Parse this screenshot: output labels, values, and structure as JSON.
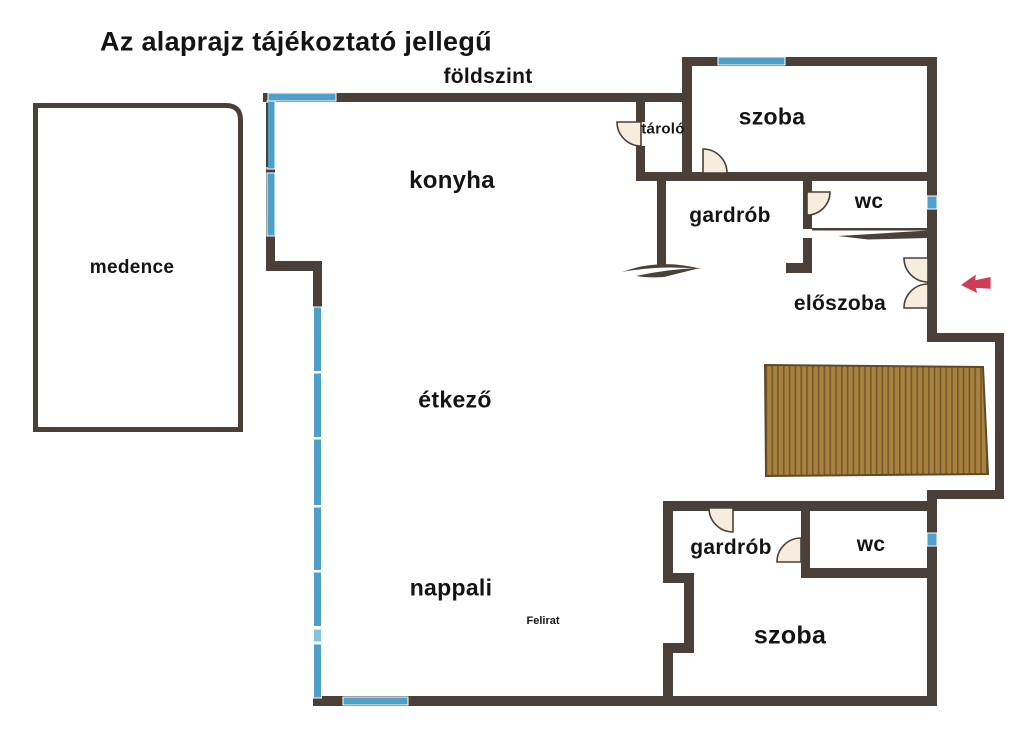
{
  "title": "Az alaprajz tájékoztató jellegű",
  "floor_label": "földszint",
  "note_label": "Felirat",
  "rooms": [
    {
      "id": "medence",
      "label": "medence"
    },
    {
      "id": "konyha",
      "label": "konyha"
    },
    {
      "id": "tarolo",
      "label": "tároló"
    },
    {
      "id": "szoba-felso",
      "label": "szoba"
    },
    {
      "id": "gardrob-felso",
      "label": "gardrób"
    },
    {
      "id": "wc-felso",
      "label": "wc"
    },
    {
      "id": "eloszoba",
      "label": "előszoba"
    },
    {
      "id": "etkezo",
      "label": "étkező"
    },
    {
      "id": "nappali",
      "label": "nappali"
    },
    {
      "id": "gardrob-also",
      "label": "gardrób"
    },
    {
      "id": "wc-also",
      "label": "wc"
    },
    {
      "id": "szoba-also",
      "label": "szoba"
    }
  ],
  "icons": {
    "entrance_arrow": "left-arrow",
    "door_swing": "quarter-circle-door",
    "sliding_door": "tapered-line-door"
  },
  "colors": {
    "background": "#ffffff",
    "wall": "#4b4037",
    "window": "#4e9fc9",
    "window_light": "#85c4e0",
    "door": "#f6eddf",
    "deck": "#a8823e",
    "deck_line": "#73592b",
    "arrow": "#d23b55",
    "text": "#141414"
  }
}
